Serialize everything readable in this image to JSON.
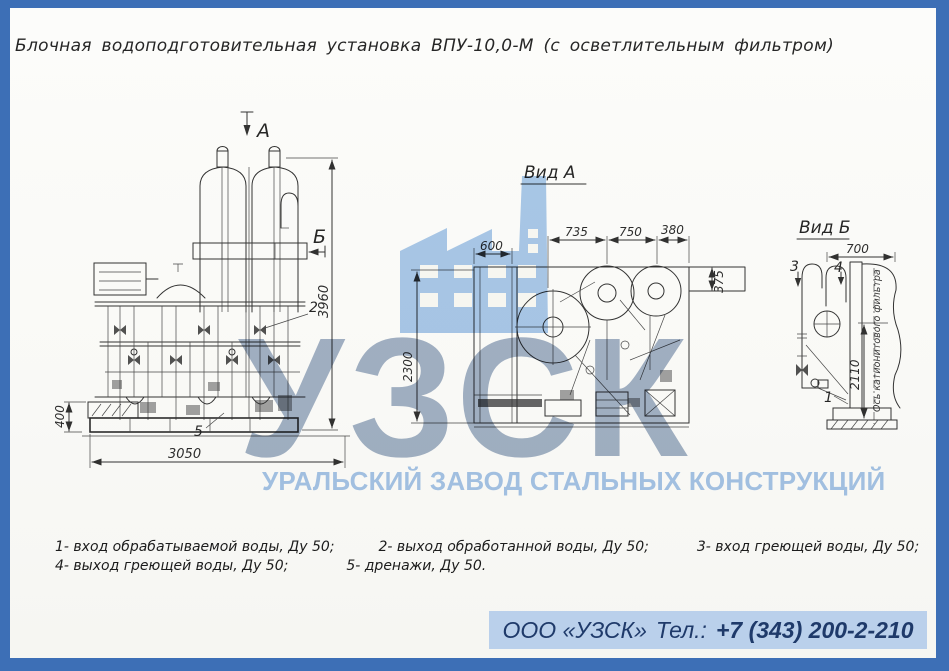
{
  "title": "Блочная водоподготовительная установка ВПУ-10,0-М (с осветлительным фильтром)",
  "front_view": {
    "section_marker_a": "А",
    "section_marker_b": "Б",
    "dim_total_height": "3960",
    "dim_foundation_height": "400",
    "dim_total_width": "3050",
    "callout_2": "2",
    "callout_5": "5"
  },
  "view_a": {
    "title": "Вид А",
    "dim_left_width": "600",
    "dim_span_1": "735",
    "dim_span_2": "750",
    "dim_span_3": "380",
    "dim_depth": "2300",
    "dim_offset": "375"
  },
  "view_b": {
    "title": "Вид Б",
    "dim_width": "700",
    "dim_height": "2110",
    "axis_label": "Ось катионитового фильтра",
    "callout_1": "1",
    "callout_3": "3",
    "callout_4": "4"
  },
  "notes": {
    "items": [
      "1- вход обрабатываемой воды, Ду 50;",
      "2- выход обработанной воды, Ду 50;",
      "3- вход греющей воды, Ду 50;",
      "4- выход греющей воды, Ду 50;",
      "5- дренажи, Ду 50."
    ]
  },
  "watermark": {
    "acronym": "УЗСК",
    "company_name": "УРАЛЬСКИЙ ЗАВОД СТАЛЬНЫХ КОНСТРУКЦИЙ"
  },
  "footer": {
    "company": "ООО «УЗСК»",
    "phone_label": "Тел.:",
    "phone_number": "+7 (343) 200-2-210"
  },
  "colors": {
    "frame_blue": "#3d6fb6",
    "watermark_blue": "#aac9ec",
    "watermark_gray_blue": "#a3b2c7",
    "footer_band": "#bad0eb",
    "footer_text": "#1f3a6a",
    "ink": "#222222"
  }
}
